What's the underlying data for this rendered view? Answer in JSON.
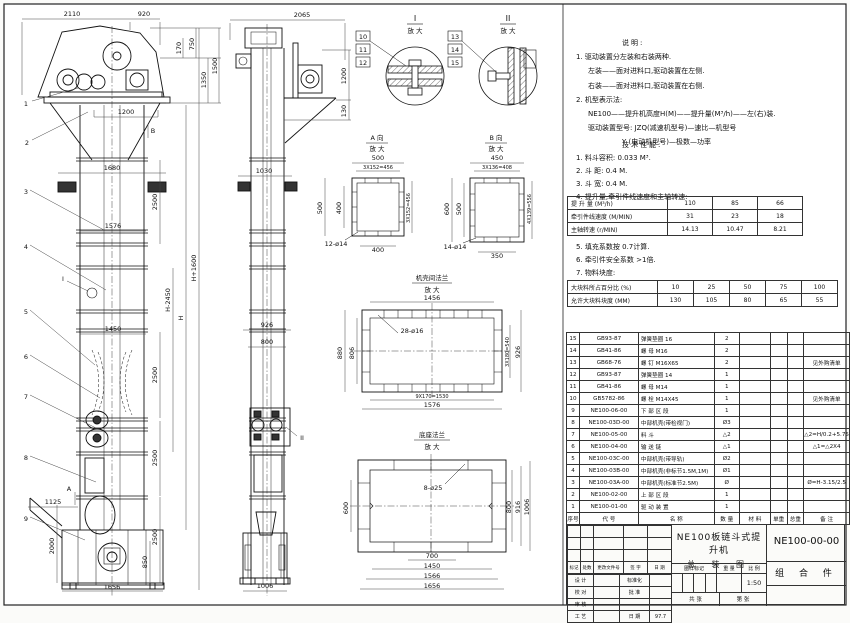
{
  "notes": {
    "heading": "说明:",
    "lines": [
      "1. 驱动装置分左装和右装两种.",
      "左装——面对进料口,驱动装置在左侧.",
      "右装——面对进料口,驱动装置在右侧.",
      "2. 机型表示法:",
      "NE100——提升机高度H(M)——提升量(M³/h)——左(右)装.",
      "驱动装置型号: JZQ(减速机型号)—速比—机型号",
      "Y (电动机型号)—极数—功率"
    ]
  },
  "specs": {
    "heading": "技术性能:",
    "items_top": [
      "1. 料斗容积: 0.033 M³.",
      "2. 斗    距: 0.4 M.",
      "3. 斗    宽: 0.4 M.",
      "4. 提升量,牵引件线速度和主轴转速:"
    ],
    "table1": {
      "rows": [
        {
          "label": "提 升 量  (M³/h)",
          "values": [
            "110",
            "85",
            "66"
          ]
        },
        {
          "label": "牵引件线速度 (M/MIN)",
          "values": [
            "31",
            "23",
            "18"
          ]
        },
        {
          "label": "主轴转速 (r/MIN)",
          "values": [
            "14.13",
            "10.47",
            "8.21"
          ]
        }
      ]
    },
    "items_mid": [
      "5. 填充系数按 0.7计算.",
      "6. 牵引件安全系数 >1倍.",
      "7. 物料块度:"
    ],
    "table2": {
      "rows": [
        {
          "label": "大块料所占百分比  (%)",
          "values": [
            "10",
            "25",
            "50",
            "75",
            "100"
          ]
        },
        {
          "label": "允许大块料块度  (MM)",
          "values": [
            "130",
            "105",
            "80",
            "65",
            "55"
          ]
        }
      ]
    }
  },
  "bom": {
    "headers": [
      "序号",
      "代  号",
      "名  称",
      "数 量",
      "材  料",
      "单重",
      "总重",
      "备  注"
    ],
    "rows": [
      {
        "no": "15",
        "code": "GB93-87",
        "name": "弹簧垫圈 16",
        "qty": "2",
        "material": "",
        "unit_weight": "",
        "total_weight": "",
        "remark": ""
      },
      {
        "no": "14",
        "code": "GB41-86",
        "name": "螺 母  M16",
        "qty": "2",
        "material": "",
        "unit_weight": "",
        "total_weight": "",
        "remark": ""
      },
      {
        "no": "13",
        "code": "GB68-76",
        "name": "螺 钉  M16X65",
        "qty": "2",
        "material": "",
        "unit_weight": "",
        "total_weight": "",
        "remark": "见外购清单"
      },
      {
        "no": "12",
        "code": "GB93-87",
        "name": "弹簧垫圈 14",
        "qty": "1",
        "material": "",
        "unit_weight": "",
        "total_weight": "",
        "remark": ""
      },
      {
        "no": "11",
        "code": "GB41-86",
        "name": "螺 母  M14",
        "qty": "1",
        "material": "",
        "unit_weight": "",
        "total_weight": "",
        "remark": ""
      },
      {
        "no": "10",
        "code": "GB5782-86",
        "name": "螺 栓  M14X45",
        "qty": "1",
        "material": "",
        "unit_weight": "",
        "total_weight": "",
        "remark": "见外购清单"
      },
      {
        "no": "9",
        "code": "NE100-06-00",
        "name": "下 部 区 段",
        "qty": "1",
        "material": "",
        "unit_weight": "",
        "total_weight": "",
        "remark": ""
      },
      {
        "no": "8",
        "code": "NE100-03D-00",
        "name": "中部机壳(带检视门)",
        "qty": "Ø3",
        "material": "",
        "unit_weight": "",
        "total_weight": "",
        "remark": ""
      },
      {
        "no": "7",
        "code": "NE100-05-00",
        "name": "料  斗",
        "qty": "△2",
        "material": "",
        "unit_weight": "",
        "total_weight": "",
        "remark": "△2=H/0.2+5.75"
      },
      {
        "no": "6",
        "code": "NE100-04-00",
        "name": "输 送 链",
        "qty": "△1",
        "material": "",
        "unit_weight": "",
        "total_weight": "",
        "remark": "△1=△2X4"
      },
      {
        "no": "5",
        "code": "NE100-03C-00",
        "name": "中部机壳(带导轨)",
        "qty": "Ø2",
        "material": "",
        "unit_weight": "",
        "total_weight": "",
        "remark": ""
      },
      {
        "no": "4",
        "code": "NE100-03B-00",
        "name": "中部机壳(非标节1.5M,1M)",
        "qty": "Ø1",
        "material": "",
        "unit_weight": "",
        "total_weight": "",
        "remark": ""
      },
      {
        "no": "3",
        "code": "NE100-03A-00",
        "name": "中部机壳(标准节2.5M)",
        "qty": "Ø",
        "material": "",
        "unit_weight": "",
        "total_weight": "",
        "remark": "Ø=H-3.15/2.5"
      },
      {
        "no": "2",
        "code": "NE100-02-00",
        "name": "上 部 区 段",
        "qty": "1",
        "material": "",
        "unit_weight": "",
        "total_weight": "",
        "remark": ""
      },
      {
        "no": "1",
        "code": "NE100-01-00",
        "name": "驱 动 装 置",
        "qty": "1",
        "material": "",
        "unit_weight": "",
        "total_weight": "",
        "remark": ""
      }
    ]
  },
  "titleblock": {
    "drawing_name_1": "NE100板链斗式提升机",
    "drawing_name_2": "总 装 图",
    "drawing_no": "NE100-00-00",
    "part_type": "组 合 件",
    "rev_headers": [
      "标记",
      "处数",
      "更改文件号",
      "签 字",
      "日 期"
    ],
    "roles": [
      [
        "设 计",
        "",
        "标准化",
        ""
      ],
      [
        "校 对",
        "",
        "批 准",
        ""
      ],
      [
        "审 核",
        "",
        "",
        ""
      ],
      [
        "工 艺",
        "",
        "日 期",
        "97.7"
      ]
    ],
    "mark_label": "图样标记",
    "weight_label": "重 量",
    "scale_label": "比 例",
    "scale": "1:50",
    "sheet_label_1": "共  张",
    "sheet_label_2": "第  张"
  },
  "drawing": {
    "front": {
      "dims": [
        "2110",
        "920",
        "170",
        "750",
        "1350",
        "1500",
        "1200",
        "1680",
        "1576",
        "1450",
        "1125",
        "2000",
        "850",
        "1656"
      ],
      "dims2500": [
        "2500",
        "2500",
        "2500",
        "2500"
      ],
      "dimsH": [
        "H-2450",
        "H",
        "H+1600"
      ],
      "callouts": [
        "1",
        "2",
        "3",
        "4",
        "5",
        "6",
        "7",
        "8",
        "9"
      ],
      "markers": [
        "A",
        "B",
        "I"
      ]
    },
    "side": {
      "dims": [
        "2065",
        "1200",
        "130",
        "1030",
        "926",
        "800",
        "1006"
      ],
      "markers": [
        "II"
      ]
    },
    "details": {
      "i": {
        "title": "I",
        "sub": "放 大",
        "callouts": [
          "10",
          "11",
          "12"
        ]
      },
      "ii": {
        "title": "II",
        "sub": "放 大",
        "callouts": [
          "13",
          "14",
          "15"
        ]
      },
      "a": {
        "title": "A 向",
        "sub": "放 大",
        "dims": [
          "500",
          "3X152=456",
          "500",
          "400",
          "3X152=456",
          "12-ø14",
          "400"
        ]
      },
      "b": {
        "title": "B 向",
        "sub": "放 大",
        "dims": [
          "450",
          "3X136=408",
          "600",
          "500",
          "4X139=556",
          "14-ø14",
          "350"
        ]
      },
      "flange": {
        "title": "机壳间法兰",
        "sub": "放 大",
        "dims": [
          "1456",
          "28-ø16",
          "880",
          "806",
          "3X180=540",
          "926",
          "9X170=1530",
          "1576"
        ]
      },
      "base": {
        "title": "底座法兰",
        "sub": "放 大",
        "dims": [
          "8-ø25",
          "600",
          "800",
          "916",
          "1006",
          "700",
          "1450",
          "1566",
          "1656"
        ]
      }
    }
  }
}
